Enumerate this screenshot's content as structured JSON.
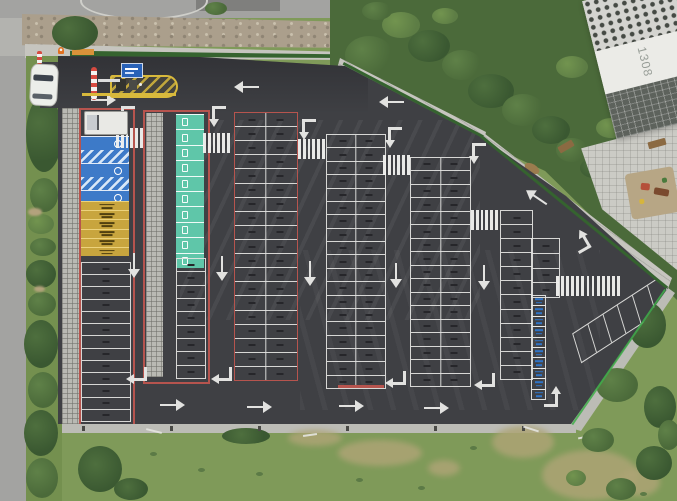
{
  "meta": {
    "scene": "Aerial top-down drone view of a large newly paved asphalt parking lot with marked stalls, next to an apartment building, roads and a grass field",
    "view": "top-down aerial photo"
  },
  "palette": {
    "asphalt": "#3f4044",
    "linewhite": "#e2e2e0",
    "linered": "#b6544e",
    "stallblue": "#3d7ac8",
    "stallteal": "#5fc6a9",
    "stallyellow": "#c8a53e",
    "motoblue": "#2f74c8",
    "grass": "#7f9a59",
    "road": "#a3a3a1",
    "sidewalk": "#b6b6b2",
    "paver": "#c6c5bf",
    "rock": "#ab9f8c",
    "plaza": "#cbcbc5",
    "curb": "#bcbcb6",
    "building": "#ebebe7",
    "buildingglass": "#5d625c",
    "fencegreen": "#3fae4a",
    "hedge": "#35632f",
    "islandyellow": "#d8b93c",
    "signblue": "#2962b8",
    "coneorange": "#e07020",
    "treemid": "#4b6a3a",
    "playsurface": "#b7a685"
  },
  "building": {
    "label": "1308"
  },
  "entrance": {
    "gate_island": "yellow hatched traffic island with ticket machines",
    "sign": "blue overhead parking sign",
    "barrier": "red-white striped pole",
    "vehicles": [
      "white car on access road",
      "white box truck parked at head of first row"
    ]
  },
  "lot": {
    "outline": [
      [
        58,
        56
      ],
      [
        200,
        57
      ],
      [
        345,
        66
      ],
      [
        483,
        138
      ],
      [
        566,
        196
      ],
      [
        668,
        288
      ],
      [
        571,
        424
      ],
      [
        58,
        424
      ]
    ],
    "sections": [
      {
        "id": "col1-frame",
        "kind": "frame",
        "x": 79,
        "y": 108,
        "w": 52,
        "h": 314,
        "stroke": "red"
      },
      {
        "id": "col1-accessible",
        "kind": "vstack",
        "x": 81,
        "y": 136,
        "w": 48,
        "cellH": 13,
        "cells": [
          "blue",
          "bluehatch",
          "blue",
          "bluehatch",
          "blue"
        ]
      },
      {
        "id": "col1-compact",
        "kind": "vstack",
        "x": 81,
        "y": 201,
        "w": 48,
        "cellH": 8.2,
        "cells": [
          "yellow",
          "yellow",
          "yellow",
          "yellow",
          "yellow",
          "yellow"
        ]
      },
      {
        "id": "col1-standard",
        "kind": "sgrid",
        "x": 81,
        "y": 262,
        "w": 48,
        "h": 158,
        "rows": 13,
        "stroke": "white"
      },
      {
        "id": "col2-frame",
        "kind": "frame",
        "x": 143,
        "y": 110,
        "w": 63,
        "h": 270,
        "stroke": "red"
      },
      {
        "id": "col2-grasscrete",
        "kind": "pavers",
        "x": 146,
        "y": 113,
        "w": 17,
        "h": 264
      },
      {
        "id": "col2-ev",
        "kind": "vstack",
        "x": 176,
        "y": 114,
        "w": 28,
        "cellH": 14.4,
        "cells": [
          "teal",
          "teal",
          "teal",
          "teal",
          "teal",
          "teal",
          "teal",
          "teal",
          "teal",
          "teal"
        ]
      },
      {
        "id": "col2-standard",
        "kind": "sgrid",
        "x": 176,
        "y": 258,
        "w": 28,
        "h": 119,
        "rows": 9,
        "stroke": "white"
      },
      {
        "id": "col3",
        "kind": "dgrid",
        "x": 234,
        "y": 112,
        "w": 62,
        "h": 267,
        "rows": 19,
        "stroke": "red"
      },
      {
        "id": "col4",
        "kind": "dgrid",
        "x": 326,
        "y": 134,
        "w": 58,
        "h": 253,
        "rows": 19,
        "stroke": "white"
      },
      {
        "id": "col4-redline",
        "kind": "fill",
        "x": 338,
        "y": 385,
        "w": 46,
        "h": 3,
        "color": "linered"
      },
      {
        "id": "col5",
        "kind": "dgrid",
        "x": 410,
        "y": 157,
        "w": 59,
        "h": 228,
        "rows": 17,
        "stroke": "white"
      },
      {
        "id": "col6-left",
        "kind": "sgrid",
        "x": 500,
        "y": 210,
        "w": 31,
        "h": 168,
        "rows": 12,
        "stroke": "white"
      },
      {
        "id": "col6-right",
        "kind": "sgrid",
        "x": 531,
        "y": 238,
        "w": 27,
        "h": 58,
        "rows": 4,
        "stroke": "white"
      },
      {
        "id": "col6-moto",
        "kind": "vstack",
        "x": 531,
        "y": 296,
        "w": 15,
        "cellH": 9.4,
        "cells": [
          "moto",
          "moto",
          "moto",
          "moto",
          "moto",
          "moto",
          "moto",
          "moto",
          "moto",
          "moto"
        ]
      },
      {
        "id": "angled-bank",
        "kind": "angled",
        "x": 568,
        "y": 304,
        "w": 106,
        "h": 28,
        "cells": 6,
        "rot": -33,
        "skew": -16
      }
    ],
    "crosswalks": [
      {
        "x": 116,
        "y": 128,
        "w": 27,
        "h": 20,
        "bars": 6,
        "dir": "v"
      },
      {
        "x": 203,
        "y": 133,
        "w": 27,
        "h": 20,
        "bars": 6,
        "dir": "v"
      },
      {
        "x": 298,
        "y": 139,
        "w": 27,
        "h": 20,
        "bars": 6,
        "dir": "v"
      },
      {
        "x": 383,
        "y": 155,
        "w": 27,
        "h": 20,
        "bars": 6,
        "dir": "v"
      },
      {
        "x": 471,
        "y": 210,
        "w": 27,
        "h": 20,
        "bars": 6,
        "dir": "v"
      },
      {
        "x": 556,
        "y": 276,
        "w": 64,
        "h": 20,
        "bars": 13,
        "dir": "v"
      },
      {
        "x": 16,
        "y": 54,
        "w": 26,
        "h": 47,
        "bars": 6,
        "dir": "h"
      },
      {
        "x": 0,
        "y": 0,
        "w": 13,
        "h": 11,
        "bars": 3,
        "dir": "v"
      }
    ],
    "arrows": [
      {
        "t": "left",
        "x": 246,
        "y": 87
      },
      {
        "t": "left",
        "x": 391,
        "y": 102
      },
      {
        "t": "right",
        "x": 104,
        "y": 100
      },
      {
        "t": "bent-es",
        "x": 128,
        "y": 117
      },
      {
        "t": "bent-es",
        "x": 219,
        "y": 117
      },
      {
        "t": "bent-es",
        "x": 309,
        "y": 130
      },
      {
        "t": "bent-es",
        "x": 395,
        "y": 138
      },
      {
        "t": "bent-es",
        "x": 479,
        "y": 154
      },
      {
        "t": "down",
        "x": 134,
        "y": 266
      },
      {
        "t": "down",
        "x": 222,
        "y": 269
      },
      {
        "t": "down",
        "x": 310,
        "y": 274
      },
      {
        "t": "down",
        "x": 396,
        "y": 276
      },
      {
        "t": "down",
        "x": 484,
        "y": 278
      },
      {
        "t": "bent-nw",
        "x": 136,
        "y": 374
      },
      {
        "t": "bent-nw",
        "x": 221,
        "y": 374
      },
      {
        "t": "bent-nw",
        "x": 395,
        "y": 378
      },
      {
        "t": "bent-nw",
        "x": 484,
        "y": 380
      },
      {
        "t": "right",
        "x": 173,
        "y": 405
      },
      {
        "t": "right",
        "x": 260,
        "y": 407
      },
      {
        "t": "right",
        "x": 352,
        "y": 406
      },
      {
        "t": "right",
        "x": 437,
        "y": 408
      },
      {
        "t": "bent-wn",
        "x": 551,
        "y": 396
      },
      {
        "t": "diag",
        "x": 536,
        "y": 197
      },
      {
        "t": "bent-diag",
        "x": 580,
        "y": 241
      }
    ]
  },
  "vegetation": {
    "left_strip": [
      [
        26,
        96,
        36,
        76,
        0
      ],
      [
        30,
        178,
        28,
        34,
        1
      ],
      [
        28,
        214,
        26,
        20,
        2
      ],
      [
        30,
        238,
        26,
        18,
        1
      ],
      [
        26,
        260,
        30,
        28,
        0
      ],
      [
        28,
        292,
        28,
        24,
        1
      ],
      [
        24,
        320,
        34,
        48,
        0
      ],
      [
        28,
        372,
        30,
        36,
        1
      ],
      [
        24,
        410,
        34,
        46,
        0
      ],
      [
        26,
        458,
        32,
        40,
        1
      ]
    ],
    "top_right": [
      [
        345,
        36,
        48,
        38,
        1
      ],
      [
        382,
        12,
        38,
        26,
        2
      ],
      [
        408,
        30,
        42,
        32,
        0
      ],
      [
        442,
        50,
        40,
        30,
        1
      ],
      [
        468,
        74,
        46,
        34,
        0
      ],
      [
        502,
        94,
        42,
        32,
        1
      ],
      [
        532,
        116,
        38,
        28,
        0
      ],
      [
        556,
        138,
        32,
        24,
        1
      ],
      [
        580,
        158,
        28,
        20,
        0
      ],
      [
        556,
        56,
        32,
        22,
        2
      ],
      [
        588,
        14,
        28,
        18,
        1
      ],
      [
        606,
        62,
        36,
        26,
        0
      ],
      [
        640,
        88,
        28,
        18,
        1
      ],
      [
        596,
        118,
        30,
        20,
        2
      ],
      [
        362,
        2,
        30,
        18,
        1
      ],
      [
        432,
        8,
        26,
        16,
        2
      ],
      [
        658,
        128,
        26,
        38,
        0
      ],
      [
        618,
        146,
        22,
        16,
        1
      ],
      [
        52,
        16,
        46,
        34,
        0
      ],
      [
        205,
        2,
        22,
        13,
        1
      ]
    ],
    "bottom_right": [
      [
        628,
        302,
        38,
        46,
        0
      ],
      [
        596,
        368,
        42,
        34,
        1
      ],
      [
        644,
        386,
        32,
        42,
        0
      ],
      [
        582,
        428,
        32,
        24,
        1
      ],
      [
        636,
        446,
        36,
        34,
        0
      ],
      [
        606,
        478,
        30,
        22,
        1
      ],
      [
        658,
        420,
        22,
        30,
        1
      ],
      [
        566,
        470,
        20,
        16,
        2
      ]
    ],
    "tan_patches": [
      [
        28,
        208,
        14,
        8
      ],
      [
        34,
        286,
        11,
        6
      ]
    ]
  },
  "field": {
    "dry_patches": [
      [
        288,
        430,
        54,
        16
      ],
      [
        338,
        440,
        84,
        26
      ],
      [
        428,
        460,
        32,
        16
      ],
      [
        492,
        426,
        62,
        32
      ],
      [
        542,
        450,
        96,
        50
      ],
      [
        618,
        468,
        42,
        28
      ]
    ],
    "bushes": [
      [
        222,
        428,
        48,
        16
      ],
      [
        78,
        446,
        44,
        46
      ],
      [
        114,
        478,
        34,
        22
      ]
    ],
    "tufts": [
      [
        150,
        452
      ],
      [
        198,
        468
      ],
      [
        256,
        472
      ],
      [
        418,
        486
      ],
      [
        470,
        446
      ],
      [
        356,
        478
      ],
      [
        640,
        492
      ]
    ],
    "posts_x": [
      82,
      170,
      258,
      346,
      434,
      522
    ],
    "markers": [
      [
        146,
        430,
        16,
        14
      ],
      [
        303,
        434,
        14,
        -8
      ],
      [
        523,
        428,
        16,
        18
      ],
      [
        578,
        436,
        14,
        -12
      ]
    ]
  },
  "playground": {
    "items": [
      {
        "x": 14,
        "y": 12,
        "w": 9,
        "h": 7,
        "color": "#b5503a",
        "rot": 15
      },
      {
        "x": 26,
        "y": 20,
        "w": 15,
        "h": 7,
        "color": "#7a4a2e",
        "rot": 20
      },
      {
        "x": 10,
        "y": 27,
        "w": 5,
        "h": 5,
        "color": "#d6b53c",
        "rot": 0
      },
      {
        "x": 36,
        "y": 10,
        "w": 5,
        "h": 5,
        "color": "#4a7a3c",
        "rot": 0
      }
    ]
  }
}
